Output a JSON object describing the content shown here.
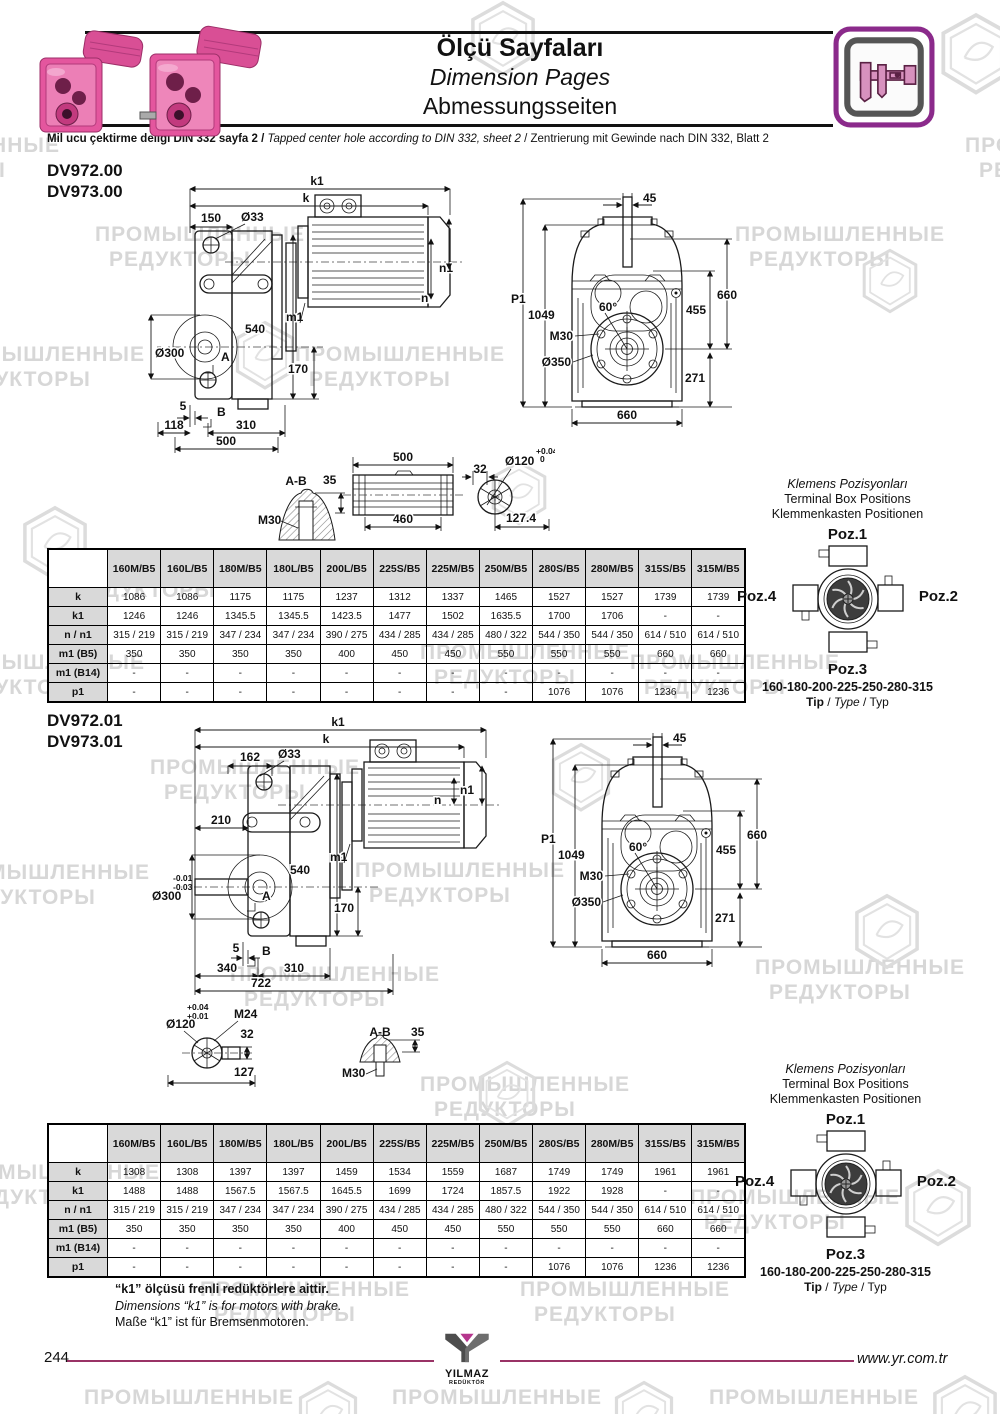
{
  "colors": {
    "brand_magenta": "#993366",
    "icon_border_magenta": "#8b2a8b",
    "product_pink": "#e4569e",
    "table_header_bg": "#d9d9d9",
    "watermark_gray": "#d7d7d7"
  },
  "watermark": {
    "line1": "ПРОМЫШЛЕННЫЕ",
    "line2": "РЕДУКТОРЫ"
  },
  "header": {
    "title_tr": "Ölçü Sayfaları",
    "title_en": "Dimension Pages",
    "title_de": "Abmessungsseiten",
    "din_tr": "Mil ucu çektirme deliği DIN 332 sayfa 2 /",
    "din_en": "Tapped center hole according to DIN 332, sheet 2",
    "din_de": "/ Zentrierung mit Gewinde nach DIN 332, Blatt 2"
  },
  "sections": [
    {
      "model_a": "DV972.00",
      "model_b": "DV973.00",
      "side": {
        "k1": "k1",
        "k": "k",
        "len150": "150",
        "dia33": "Ø33",
        "n1": "n1",
        "n": "n",
        "m1": "m1",
        "h540": "540",
        "dia300": "Ø300",
        "h170": "170",
        "secA": "A",
        "secB": "B",
        "gap5": "5",
        "len118": "118",
        "len310": "310",
        "len500": "500"
      },
      "front": {
        "w45": "45",
        "p1": "P1",
        "h1049": "1049",
        "ang60": "60°",
        "m30": "M30",
        "dia350": "Ø350",
        "h660": "660",
        "h455": "455",
        "h271": "271",
        "w660": "660"
      },
      "detail": {
        "sec": "A-B",
        "h35": "35",
        "m30": "M30",
        "len500": "500",
        "len460": "460",
        "w32": "32",
        "dia120": "Ø120",
        "tol_top": "+0.04",
        "tol_bot": "0",
        "len1274": "127.4"
      }
    },
    {
      "model_a": "DV972.01",
      "model_b": "DV973.01",
      "side": {
        "k1": "k1",
        "k": "k",
        "len162": "162",
        "dia33": "Ø33",
        "n1": "n1",
        "n": "n",
        "len210": "210",
        "m1": "m1",
        "h540": "540",
        "dia300": "Ø300",
        "tol_top": "-0.01",
        "tol_bot": "-0.03",
        "secA": "A",
        "h170": "170",
        "gap5": "5",
        "secB": "B",
        "len340": "340",
        "len310": "310",
        "len722": "722"
      },
      "front": {
        "w45": "45",
        "p1": "P1",
        "h1049": "1049",
        "ang60": "60°",
        "m30": "M30",
        "dia350": "Ø350",
        "h660": "660",
        "h455": "455",
        "h271": "271",
        "w660": "660"
      },
      "detail": {
        "tol_top": "+0.04",
        "tol_bot": "+0.01",
        "dia120": "Ø120",
        "m24": "M24",
        "w32": "32",
        "len127": "127",
        "sec": "A-B",
        "h35": "35",
        "m30": "M30"
      }
    }
  ],
  "terminal_box": {
    "title_tr": "Klemens Pozisyonları",
    "title_en": "Terminal Box Positions",
    "title_de": "Klemmenkasten Positionen",
    "poz1": "Poz.1",
    "poz2": "Poz.2",
    "poz3": "Poz.3",
    "poz4": "Poz.4",
    "sizes": "160-180-200-225-250-280-315",
    "tip": "Tip",
    "type": "Type",
    "typ": "Typ"
  },
  "tables": [
    {
      "headers": [
        "160M/B5",
        "160L/B5",
        "180M/B5",
        "180L/B5",
        "200L/B5",
        "225S/B5",
        "225M/B5",
        "250M/B5",
        "280S/B5",
        "280M/B5",
        "315S/B5",
        "315M/B5"
      ],
      "rows": [
        {
          "label": "k",
          "values": [
            "1086",
            "1086",
            "1175",
            "1175",
            "1237",
            "1312",
            "1337",
            "1465",
            "1527",
            "1527",
            "1739",
            "1739"
          ]
        },
        {
          "label": "k1",
          "values": [
            "1246",
            "1246",
            "1345.5",
            "1345.5",
            "1423.5",
            "1477",
            "1502",
            "1635.5",
            "1700",
            "1706",
            "-",
            "-"
          ]
        },
        {
          "label": "n / n1",
          "values": [
            "315 / 219",
            "315 / 219",
            "347 / 234",
            "347 / 234",
            "390 / 275",
            "434 / 285",
            "434 / 285",
            "480 / 322",
            "544 / 350",
            "544 / 350",
            "614 / 510",
            "614 / 510"
          ]
        },
        {
          "label": "m1 (B5)",
          "values": [
            "350",
            "350",
            "350",
            "350",
            "400",
            "450",
            "450",
            "550",
            "550",
            "550",
            "660",
            "660"
          ]
        },
        {
          "label": "m1 (B14)",
          "values": [
            "-",
            "-",
            "-",
            "-",
            "-",
            "-",
            "-",
            "-",
            "-",
            "-",
            "-",
            "-"
          ]
        },
        {
          "label": "p1",
          "values": [
            "-",
            "-",
            "-",
            "-",
            "-",
            "-",
            "-",
            "-",
            "1076",
            "1076",
            "1236",
            "1236"
          ]
        }
      ]
    },
    {
      "headers": [
        "160M/B5",
        "160L/B5",
        "180M/B5",
        "180L/B5",
        "200L/B5",
        "225S/B5",
        "225M/B5",
        "250M/B5",
        "280S/B5",
        "280M/B5",
        "315S/B5",
        "315M/B5"
      ],
      "rows": [
        {
          "label": "k",
          "values": [
            "1308",
            "1308",
            "1397",
            "1397",
            "1459",
            "1534",
            "1559",
            "1687",
            "1749",
            "1749",
            "1961",
            "1961"
          ]
        },
        {
          "label": "k1",
          "values": [
            "1488",
            "1488",
            "1567.5",
            "1567.5",
            "1645.5",
            "1699",
            "1724",
            "1857.5",
            "1922",
            "1928",
            "-",
            "-"
          ]
        },
        {
          "label": "n / n1",
          "values": [
            "315 / 219",
            "315 / 219",
            "347 / 234",
            "347 / 234",
            "390 / 275",
            "434 / 285",
            "434 / 285",
            "480 / 322",
            "544 / 350",
            "544 / 350",
            "614 / 510",
            "614 / 510"
          ]
        },
        {
          "label": "m1 (B5)",
          "values": [
            "350",
            "350",
            "350",
            "350",
            "400",
            "450",
            "450",
            "550",
            "550",
            "550",
            "660",
            "660"
          ]
        },
        {
          "label": "m1 (B14)",
          "values": [
            "-",
            "-",
            "-",
            "-",
            "-",
            "-",
            "-",
            "-",
            "-",
            "-",
            "-",
            "-"
          ]
        },
        {
          "label": "p1",
          "values": [
            "-",
            "-",
            "-",
            "-",
            "-",
            "-",
            "-",
            "-",
            "1076",
            "1076",
            "1236",
            "1236"
          ]
        }
      ]
    }
  ],
  "notes": {
    "tr": "“k1” ölçüsü frenli redüktörlere aittir.",
    "en": "Dimensions “k1” is for motors with brake.",
    "de": "Maße “k1” ist für Bremsenmotoren."
  },
  "footer": {
    "page": "244",
    "url": "www.yr.com.tr",
    "logo_top": "YILMAZ",
    "logo_bottom": "REDÜKTÖR"
  }
}
